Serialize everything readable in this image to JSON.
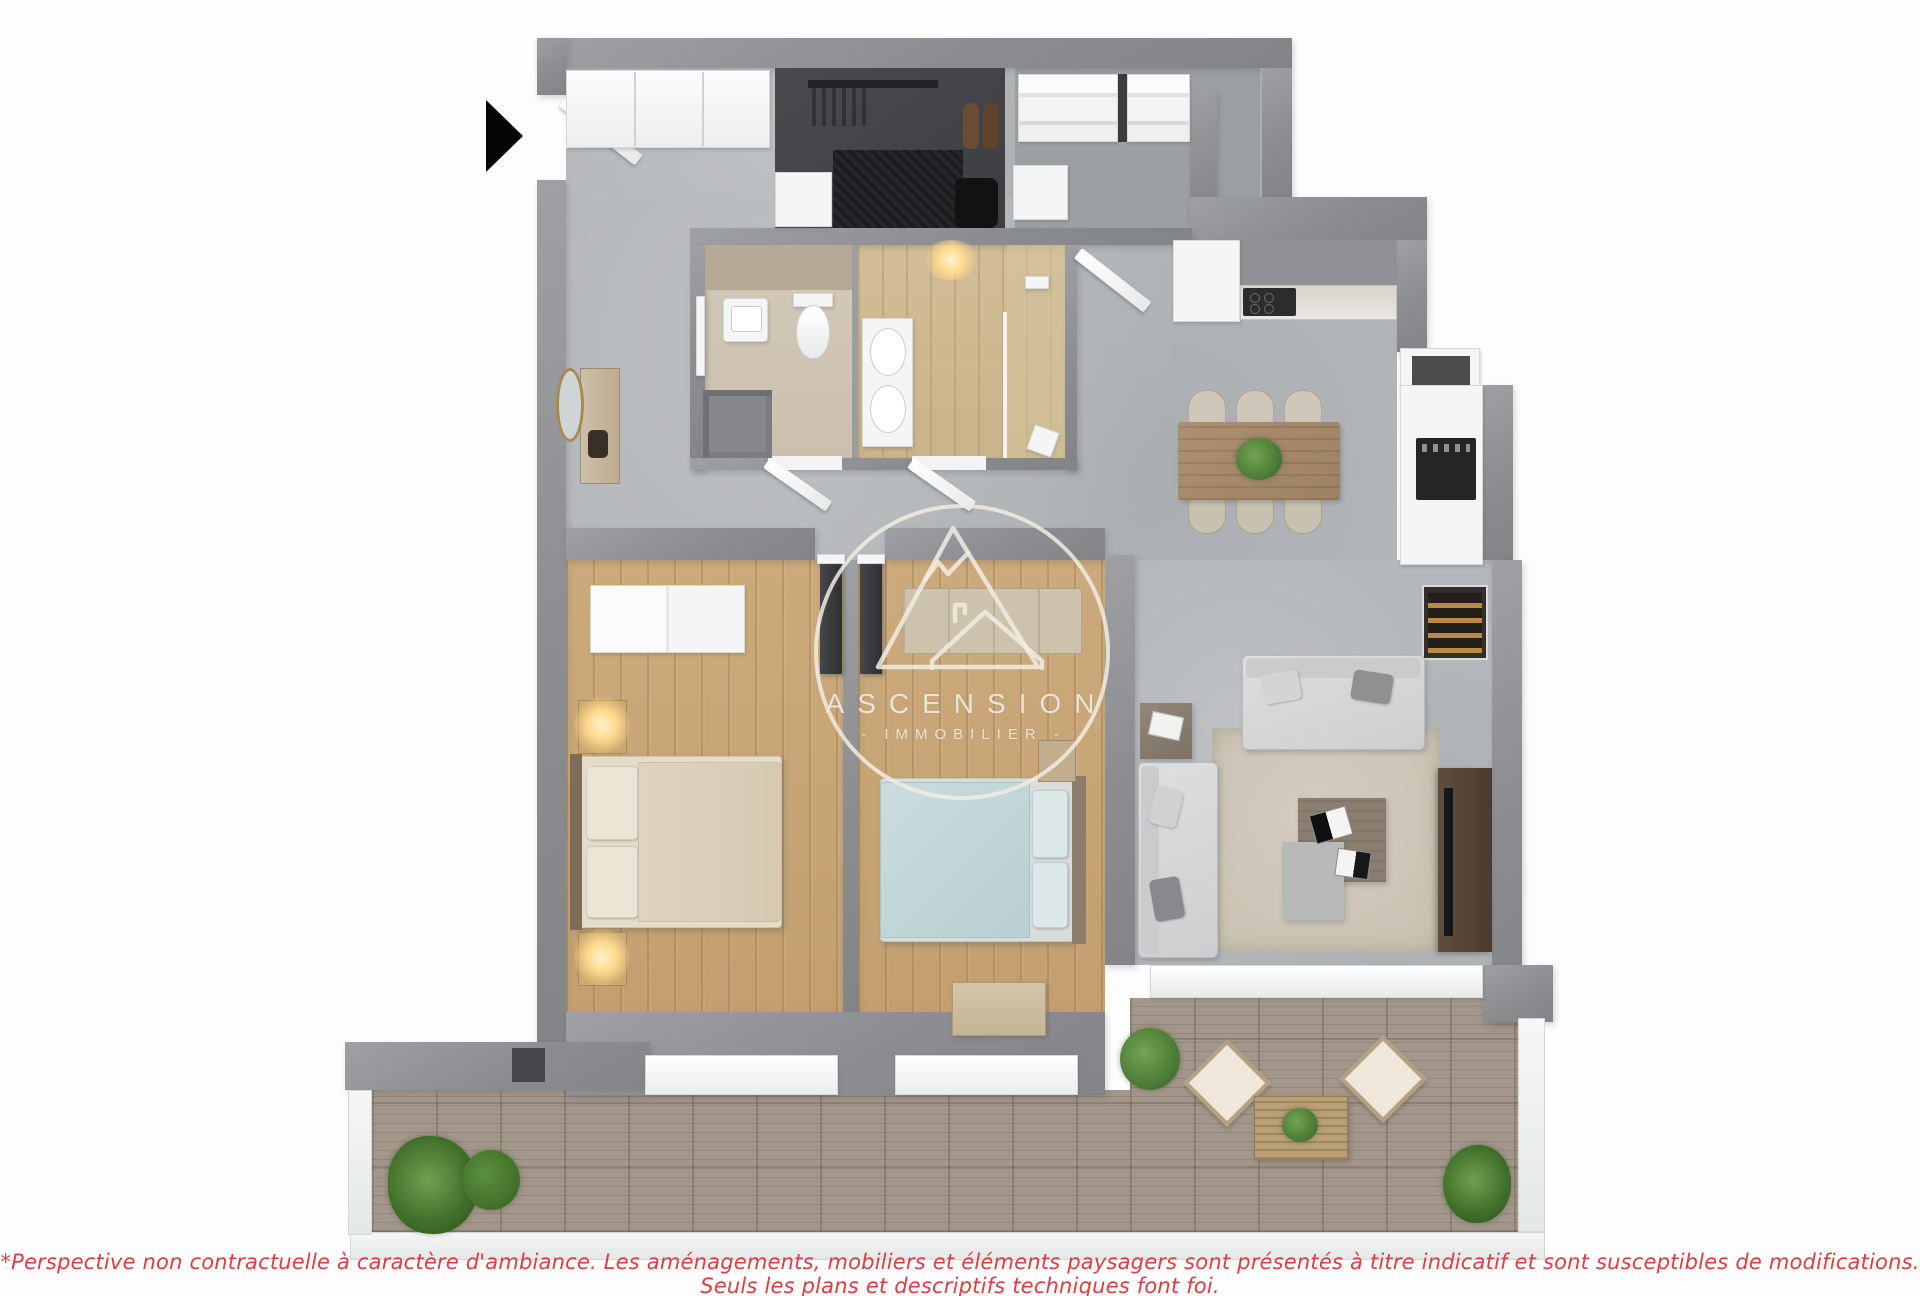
{
  "watermark": {
    "brand": "ASCENSION",
    "tagline": "- IMMOBILIER -",
    "color": "#f1ece1",
    "logo_icon": "mountain-house-circle-logo"
  },
  "disclaimer": {
    "text": "*Perspective non contractuelle à caractère d'ambiance. Les aménagements, mobiliers et éléments paysagers sont présentés à titre indicatif et sont susceptibles de modifications. Seuls les plans et descriptifs techniques font foi.",
    "color": "#e23b40"
  },
  "entrance_arrow": {
    "icon": "right-arrow-icon",
    "color": "#000000"
  },
  "palette": {
    "wall_gray": "#8b8d90",
    "concrete_floor": "#b4b7ba",
    "bedroom_wood": "#c9a878",
    "bathroom_beige": "#cfc5b4",
    "dressing_dark": "#3c3d40",
    "terrace_deck": "#a3968a",
    "bed_blue": "#c3d7d8",
    "bed_beige": "#ded4c0",
    "plant_green": "#4a7a34"
  }
}
